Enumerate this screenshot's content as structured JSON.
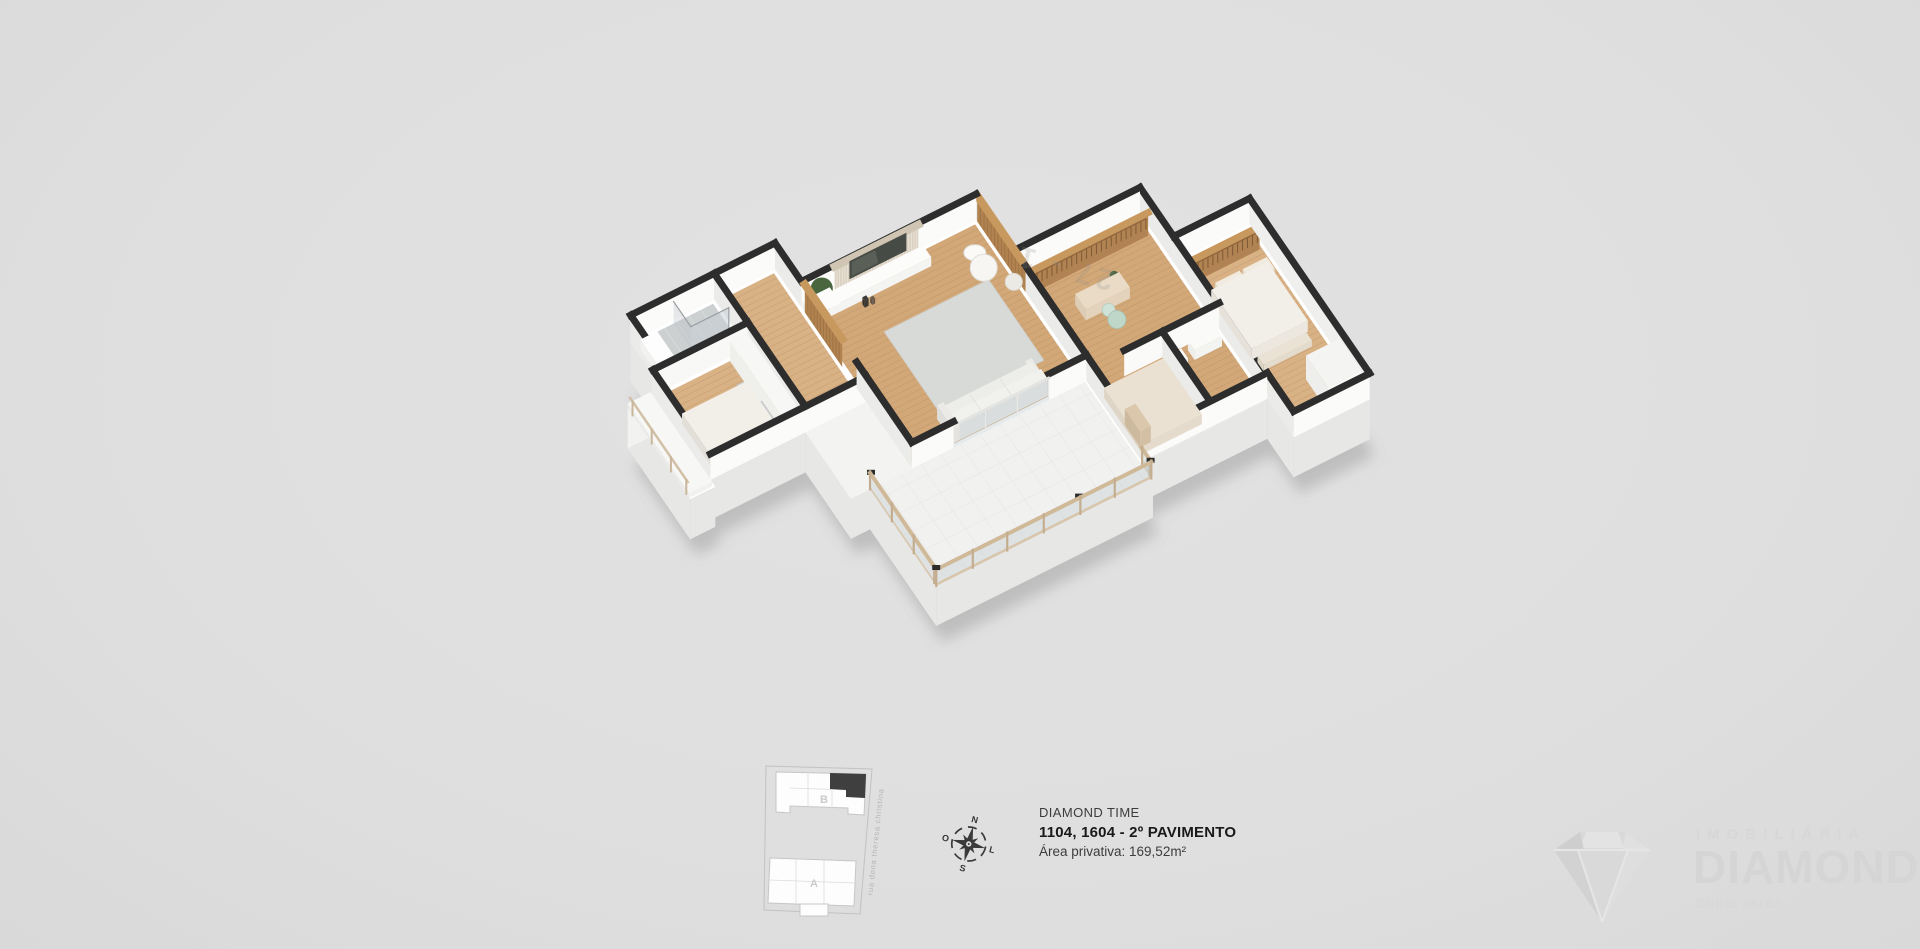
{
  "info": {
    "project": "DIAMOND TIME",
    "unit": "1104, 1604 - 2º PAVIMENTO",
    "area": "Área privativa: 169,52m²"
  },
  "brand": {
    "line1": "IMOBILIÁRIA",
    "line2": "DIAMOND",
    "creci": "CRECI 8610J"
  },
  "sitemap": {
    "street": "rua dona theresa christina",
    "building_b": "B",
    "building_a": "A"
  },
  "compass": {
    "n": "N",
    "s": "S",
    "e": "L",
    "w": "O"
  },
  "floorplan": {
    "watermark_text": "27 - 1",
    "palette": {
      "background": "#e0e0e0",
      "wall_top": "#2d2d2d",
      "wall_face": "#fbfbfa",
      "wall_side": "#ebebe9",
      "wood_floor": "#d8b185",
      "wood_floor2": "#d2a878",
      "wood_panel": "#b0824f",
      "wood_panel_top": "#c8995f",
      "closet_wood": "#b28352",
      "bath_floor": "#cdd0d1",
      "terrace_floor": "#f1f1f0",
      "glass": "rgba(195,204,210,0.42)",
      "rail_wood": "#cfb998",
      "cap_dark": "#2c2c2a",
      "slab": "#ffffff",
      "base_front": "#f2f2f1",
      "base_side": "#e7e7e6",
      "plant": "#49663f",
      "rug": "#d8dad7",
      "sofa": "#ededea",
      "bed_white": "#f2efe8",
      "bed_beige": "#eae1d3",
      "pillow_gray": "#c7c9cb",
      "pillow_beige": "#dbc8ac",
      "tv": "#474b46"
    }
  }
}
